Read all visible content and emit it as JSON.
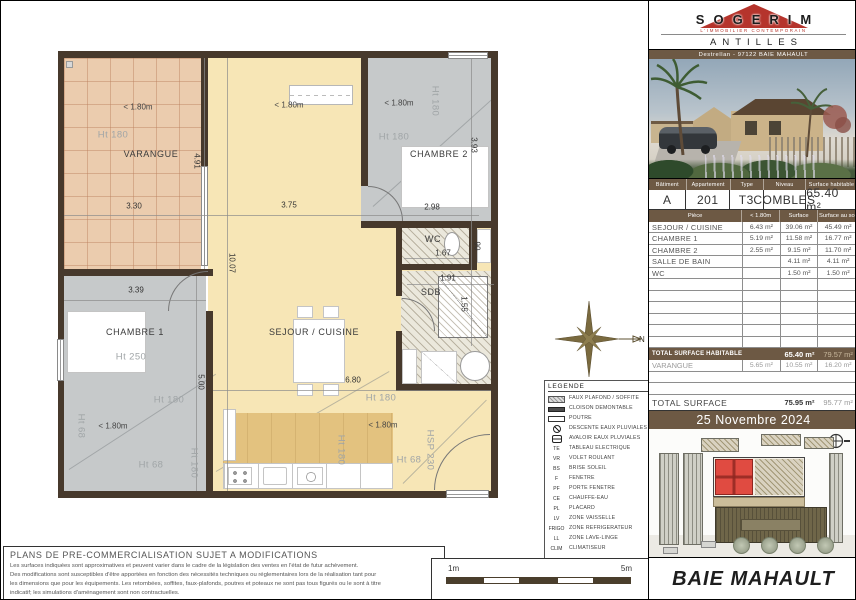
{
  "colors": {
    "brand_red": "#b5342c",
    "band_brown": "#6d5944",
    "wall": "#47392c",
    "varangue_fill": "#ebccae",
    "room_gray": "#c6c9ca",
    "sejour_fill": "#f7e6b6",
    "kitchen_fill": "#e3c27f",
    "site_unit_red": "#e04b41"
  },
  "plan": {
    "annotations": [
      {
        "t": "< 1.80m",
        "x": 137,
        "y": 106,
        "cls": "lim"
      },
      {
        "t": "Ht 180",
        "x": 112,
        "y": 134,
        "cls": "ht"
      },
      {
        "t": "VARANGUE",
        "x": 150,
        "y": 153,
        "cls": "room"
      },
      {
        "t": "3.30",
        "x": 133,
        "y": 205,
        "cls": "dim"
      },
      {
        "t": "4.91",
        "x": 196,
        "y": 160,
        "r": 90,
        "cls": "dim"
      },
      {
        "t": "< 1.80m",
        "x": 288,
        "y": 104,
        "cls": "lim"
      },
      {
        "t": "3.75",
        "x": 288,
        "y": 204,
        "cls": "dim"
      },
      {
        "t": "10.07",
        "x": 231,
        "y": 262,
        "r": 90,
        "cls": "dim"
      },
      {
        "t": "SEJOUR / CUISINE",
        "x": 313,
        "y": 331,
        "cls": "room"
      },
      {
        "t": "6.80",
        "x": 352,
        "y": 379,
        "cls": "dim"
      },
      {
        "t": "Ht 180",
        "x": 380,
        "y": 397,
        "cls": "ht"
      },
      {
        "t": "< 1.80m",
        "x": 382,
        "y": 424,
        "cls": "lim"
      },
      {
        "t": "Ht 180",
        "x": 340,
        "y": 449,
        "r": 90,
        "cls": "ht"
      },
      {
        "t": "Ht 68",
        "x": 408,
        "y": 459,
        "cls": "ht"
      },
      {
        "t": "HSP 230",
        "x": 429,
        "y": 449,
        "r": 90,
        "cls": "ht"
      },
      {
        "t": "< 1.80m",
        "x": 398,
        "y": 102,
        "cls": "lim"
      },
      {
        "t": "Ht 180",
        "x": 434,
        "y": 100,
        "r": 90,
        "cls": "ht"
      },
      {
        "t": "Ht 180",
        "x": 393,
        "y": 136,
        "cls": "ht"
      },
      {
        "t": "CHAMBRE 2",
        "x": 438,
        "y": 153,
        "cls": "room"
      },
      {
        "t": "2.98",
        "x": 431,
        "y": 206,
        "cls": "dim"
      },
      {
        "t": "3.93",
        "x": 473,
        "y": 144,
        "r": 90,
        "cls": "dim"
      },
      {
        "t": "WC",
        "x": 432,
        "y": 238,
        "cls": "room"
      },
      {
        "t": "1.67",
        "x": 442,
        "y": 252,
        "cls": "dim"
      },
      {
        "t": "90",
        "x": 476,
        "y": 245,
        "r": 90,
        "cls": "dim"
      },
      {
        "t": "1.91",
        "x": 447,
        "y": 277,
        "cls": "dim"
      },
      {
        "t": "SDB",
        "x": 430,
        "y": 291,
        "cls": "room"
      },
      {
        "t": "1.55",
        "x": 463,
        "y": 303,
        "r": 90,
        "cls": "dim"
      },
      {
        "t": "3.39",
        "x": 135,
        "y": 289,
        "cls": "dim"
      },
      {
        "t": "CHAMBRE 1",
        "x": 134,
        "y": 331,
        "cls": "room"
      },
      {
        "t": "Ht 250",
        "x": 130,
        "y": 356,
        "cls": "ht"
      },
      {
        "t": "5.00",
        "x": 200,
        "y": 381,
        "r": 90,
        "cls": "dim"
      },
      {
        "t": "Ht 180",
        "x": 168,
        "y": 399,
        "cls": "ht"
      },
      {
        "t": "< 1.80m",
        "x": 112,
        "y": 425,
        "cls": "lim"
      },
      {
        "t": "Ht 68",
        "x": 80,
        "y": 425,
        "r": 90,
        "cls": "ht"
      },
      {
        "t": "Ht 68",
        "x": 150,
        "y": 464,
        "cls": "ht"
      },
      {
        "t": "Ht 180",
        "x": 193,
        "y": 462,
        "r": 90,
        "cls": "ht"
      }
    ],
    "legend": {
      "title": "LEGENDE",
      "items": [
        {
          "cls": "hatch2",
          "abbr": "",
          "label": "FAUX PLAFOND / SOFFITE"
        },
        {
          "cls": "solid",
          "abbr": "",
          "label": "CLOISON DEMONTABLE"
        },
        {
          "cls": "outline",
          "abbr": "",
          "label": "POUTRE"
        },
        {
          "cls": "drain",
          "abbr": "",
          "label": "DESCENTE EAUX PLUVIALES"
        },
        {
          "cls": "grate",
          "abbr": "",
          "label": "AVALOIR EAUX PLUVIALES"
        },
        {
          "cls": "abbr",
          "abbr": "TE",
          "label": "TABLEAU ELECTRIQUE"
        },
        {
          "cls": "abbr",
          "abbr": "VR",
          "label": "VOLET ROULANT"
        },
        {
          "cls": "abbr",
          "abbr": "BS",
          "label": "BRISE SOLEIL"
        },
        {
          "cls": "abbr",
          "abbr": "F",
          "label": "FENETRE"
        },
        {
          "cls": "abbr",
          "abbr": "PF",
          "label": "PORTE FENETRE"
        },
        {
          "cls": "abbr",
          "abbr": "CE",
          "label": "CHAUFFE-EAU"
        },
        {
          "cls": "abbr",
          "abbr": "PL",
          "label": "PLACARD"
        },
        {
          "cls": "abbr",
          "abbr": "LV",
          "label": "ZONE VAISSELLE"
        },
        {
          "cls": "abbr",
          "abbr": "FRIGO",
          "label": "ZONE REFRIGERATEUR"
        },
        {
          "cls": "abbr",
          "abbr": "LL",
          "label": "ZONE LAVE-LINGE"
        },
        {
          "cls": "abbr",
          "abbr": "CLIM",
          "label": "CLIMATISEUR"
        }
      ]
    },
    "compass": {
      "n": "N"
    },
    "scale": {
      "left": "1m",
      "right": "5m"
    },
    "disclaimer": {
      "title": "PLANS DE PRE-COMMERCIALISATION SUJET A MODIFICATIONS",
      "lines": [
        "Les surfaces indiquées sont approximatives et peuvent varier dans le cadre de la législation des ventes en l'état de futur achèvement.",
        "Des modifications sont susceptibles d'être apportées en fonction des nécessités techniques ou réglementaires lors de la réalisation tant pour",
        "les dimensions que pour les équipements. Les retombées, soffites, faux-plafonds, poutres et poteaux ne sont pas tous figurés ou le sont à titre",
        "indicatif; les simulations d'aménagement sont non contractuelles."
      ]
    }
  },
  "panel": {
    "brand": {
      "name": "SOGERIM",
      "tagline": "L'IMMOBILIER CONTEMPORAIN",
      "region": "ANTILLES",
      "address": "Destrellan - 97122 BAIE MAHAULT"
    },
    "unit": {
      "headers": [
        {
          "t": "Bâtiment",
          "w": 18
        },
        {
          "t": "Appartement",
          "w": 21
        },
        {
          "t": "Type",
          "w": 16
        },
        {
          "t": "Niveau",
          "w": 20
        },
        {
          "t": "Surface habitable",
          "w": 25
        }
      ],
      "values": [
        {
          "t": "A",
          "w": 18
        },
        {
          "t": "201",
          "w": 21
        },
        {
          "t": "T3",
          "w": 16
        },
        {
          "t": "COMBLES",
          "w": 20
        },
        {
          "t": "65.40 m²",
          "w": 25
        }
      ]
    },
    "rooms": {
      "headers": [
        {
          "t": "Pièce",
          "w": 45
        },
        {
          "t": "< 1.80m",
          "w": 18
        },
        {
          "t": "Surface",
          "w": 18
        },
        {
          "t": "Surface au sol",
          "w": 19
        }
      ],
      "rows": [
        {
          "name": "SEJOUR / CUISINE",
          "lt": "6.43 m²",
          "s": "39.06 m²",
          "ss": "45.49 m²"
        },
        {
          "name": "CHAMBRE 1",
          "lt": "5.19 m²",
          "s": "11.58 m²",
          "ss": "16.77 m²"
        },
        {
          "name": "CHAMBRE 2",
          "lt": "2.55 m²",
          "s": "9.15 m²",
          "ss": "11.70 m²"
        },
        {
          "name": "SALLE DE BAIN",
          "lt": "",
          "s": "4.11 m²",
          "ss": "4.11 m²"
        },
        {
          "name": "WC",
          "lt": "",
          "s": "1.50 m²",
          "ss": "1.50 m²"
        },
        {
          "name": "",
          "lt": "",
          "s": "",
          "ss": ""
        },
        {
          "name": "",
          "lt": "",
          "s": "",
          "ss": ""
        },
        {
          "name": "",
          "lt": "",
          "s": "",
          "ss": ""
        },
        {
          "name": "",
          "lt": "",
          "s": "",
          "ss": ""
        },
        {
          "name": "",
          "lt": "",
          "s": "",
          "ss": ""
        },
        {
          "name": "",
          "lt": "",
          "s": "",
          "ss": ""
        }
      ]
    },
    "totals": {
      "habitable_label": "TOTAL SURFACE HABITABLE",
      "habitable_surface": "65.40 m²",
      "habitable_floor": "79.57 m²",
      "varangue": {
        "name": "VARANGUE",
        "lt": "5.65 m²",
        "s": "10.55 m²",
        "ss": "16.20 m²"
      },
      "total_label": "TOTAL SURFACE",
      "total_surface": "75.95 m²",
      "total_floor": "95.77 m²"
    },
    "date": "25 Novembre 2024",
    "city": "BAIE MAHAULT"
  }
}
